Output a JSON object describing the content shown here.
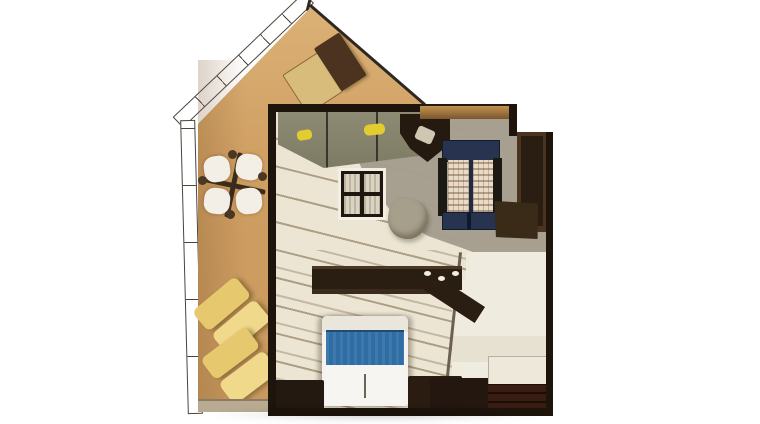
{
  "scene": {
    "type": "3d-floorplan-cutaway-top-view",
    "description": "Top-down cutaway rendering of a small gabled tiny house with a side terrace and open-plan interior",
    "text_content": "none - image contains no visible text, labels or numbers",
    "areas": [
      {
        "name": "terrace",
        "surface_color": "#cf9e62",
        "furniture": [
          {
            "name": "patio-table-set",
            "parts": "round table with four white chairs and dark frame",
            "chair_color": "#f3efe6",
            "frame_color": "#3a2c1c"
          },
          {
            "name": "sun-lounger-upper",
            "color": "#e6c96e"
          },
          {
            "name": "sun-lounger-lower",
            "color": "#f0d98a"
          }
        ]
      },
      {
        "name": "roof",
        "gable_color": "#cf9e62",
        "ridge_line_color": "#2e2822",
        "fascia_style": "white sketch band with tick marks",
        "skylight": {
          "glass_light": "#d8bc7c",
          "glass_dark": "#4b3320"
        }
      },
      {
        "name": "living-room",
        "floor_color": "#ece5d3",
        "rug_color": "#a49d8d",
        "wall_color": "#1d140c",
        "furniture": [
          {
            "name": "kitchen-counter",
            "glass_color": "#8d8b74",
            "accent_items_color": "#e3cc2f",
            "appliance_color": "#241a10"
          },
          {
            "name": "glass-top-table",
            "frame_color": "#1d1710",
            "pane_color": "#d9d3c3"
          },
          {
            "name": "floor-pouf",
            "color": "#a69f8b"
          },
          {
            "name": "daybed",
            "frame_color": "#27334f",
            "mattress_color": "#e7dcc9"
          },
          {
            "name": "wardrobe",
            "color": "#4a3420"
          },
          {
            "name": "staircase",
            "tread_color": "#f0ebdf",
            "riser_color": "#979081"
          },
          {
            "name": "desk-counter",
            "color": "#2a1d11"
          },
          {
            "name": "bed",
            "body_color": "#f5f3ef",
            "blanket_color": "#2f6ea5"
          },
          {
            "name": "dresser",
            "color": "#241710"
          },
          {
            "name": "corner-cabinet",
            "color": "#3a1d12"
          }
        ]
      }
    ]
  },
  "colors": {
    "background": "#ffffff",
    "terrace_tan": "#cf9e62",
    "roof_line": "#2e2822",
    "skylight_light": "#d8bc7c",
    "skylight_dark": "#4b3320",
    "lounger_back": "#e6c96e",
    "lounger_seat": "#f0d98a",
    "patio_white": "#f3efe6",
    "floor_cream": "#ece5d3",
    "rug_gray": "#a49d8d",
    "kitchen_glass": "#8d8b74",
    "accent_yellow": "#e3cc2f",
    "pane_fill": "#d9d3c3",
    "pouf_gray": "#a69f8b",
    "navy": "#27334f",
    "panel_cream": "#e7dcc9",
    "wardrobe_brown": "#4a3420",
    "bronze": "#a97e46",
    "stair_cream": "#f0ebdf",
    "stair_olive": "#979081",
    "desk_dark": "#2a1d11",
    "bed_white": "#f5f3ef",
    "bed_blue": "#2f6ea5",
    "dresser_brown": "#241710",
    "cabinet_redbrown": "#3a1d12",
    "wall_dark": "#1d140c"
  }
}
